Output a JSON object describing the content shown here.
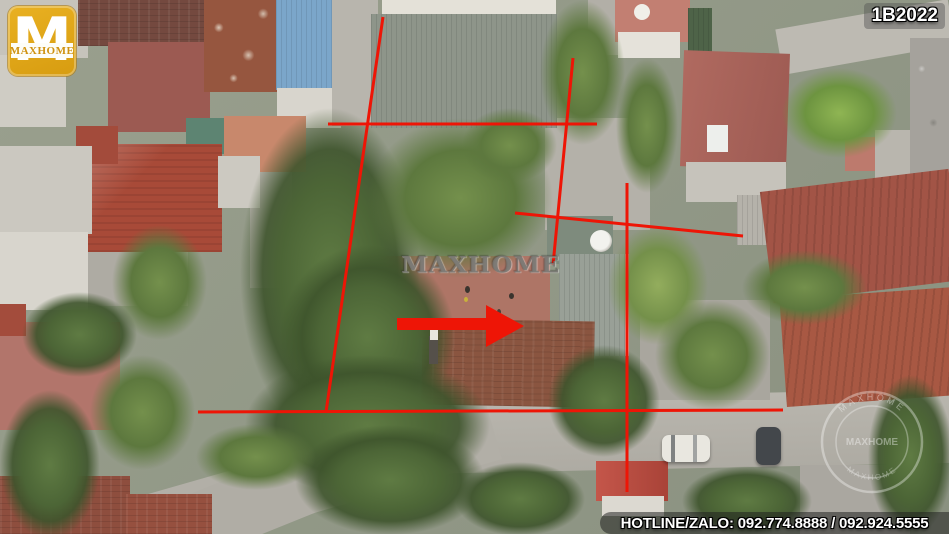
{
  "logo": {
    "monogram": "M",
    "brand": "MAXHOME"
  },
  "badge": {
    "text": "1B2022"
  },
  "watermarks": {
    "center": "MAXHOME",
    "stamp_rim_top": "MAXHOME",
    "stamp_rim_bottom": "MAXHOME",
    "stamp_center": "MAXHOME"
  },
  "hotline": {
    "text": "HOTLINE/ZALO: 092.774.8888 / 092.924.5555"
  },
  "colors": {
    "annotation_red": "#ee1506",
    "logo_gold": "#dda315"
  },
  "annotations": {
    "stroke_width": 3,
    "lines": [
      {
        "name": "left-boundary",
        "x1": 383,
        "y1": 17,
        "x2": 326,
        "y2": 412
      },
      {
        "name": "top-boundary",
        "x1": 328,
        "y1": 124,
        "x2": 597,
        "y2": 124
      },
      {
        "name": "inner-vertical",
        "x1": 573,
        "y1": 58,
        "x2": 553,
        "y2": 265
      },
      {
        "name": "middle-horizontal",
        "x1": 515,
        "y1": 213,
        "x2": 743,
        "y2": 236
      },
      {
        "name": "right-boundary",
        "x1": 627,
        "y1": 183,
        "x2": 627,
        "y2": 492
      },
      {
        "name": "bottom-boundary",
        "x1": 198,
        "y1": 412,
        "x2": 783,
        "y2": 410
      }
    ],
    "arrow": {
      "points": "397,318 486,318 486,305 524,326 486,347 486,330 397,330"
    }
  }
}
